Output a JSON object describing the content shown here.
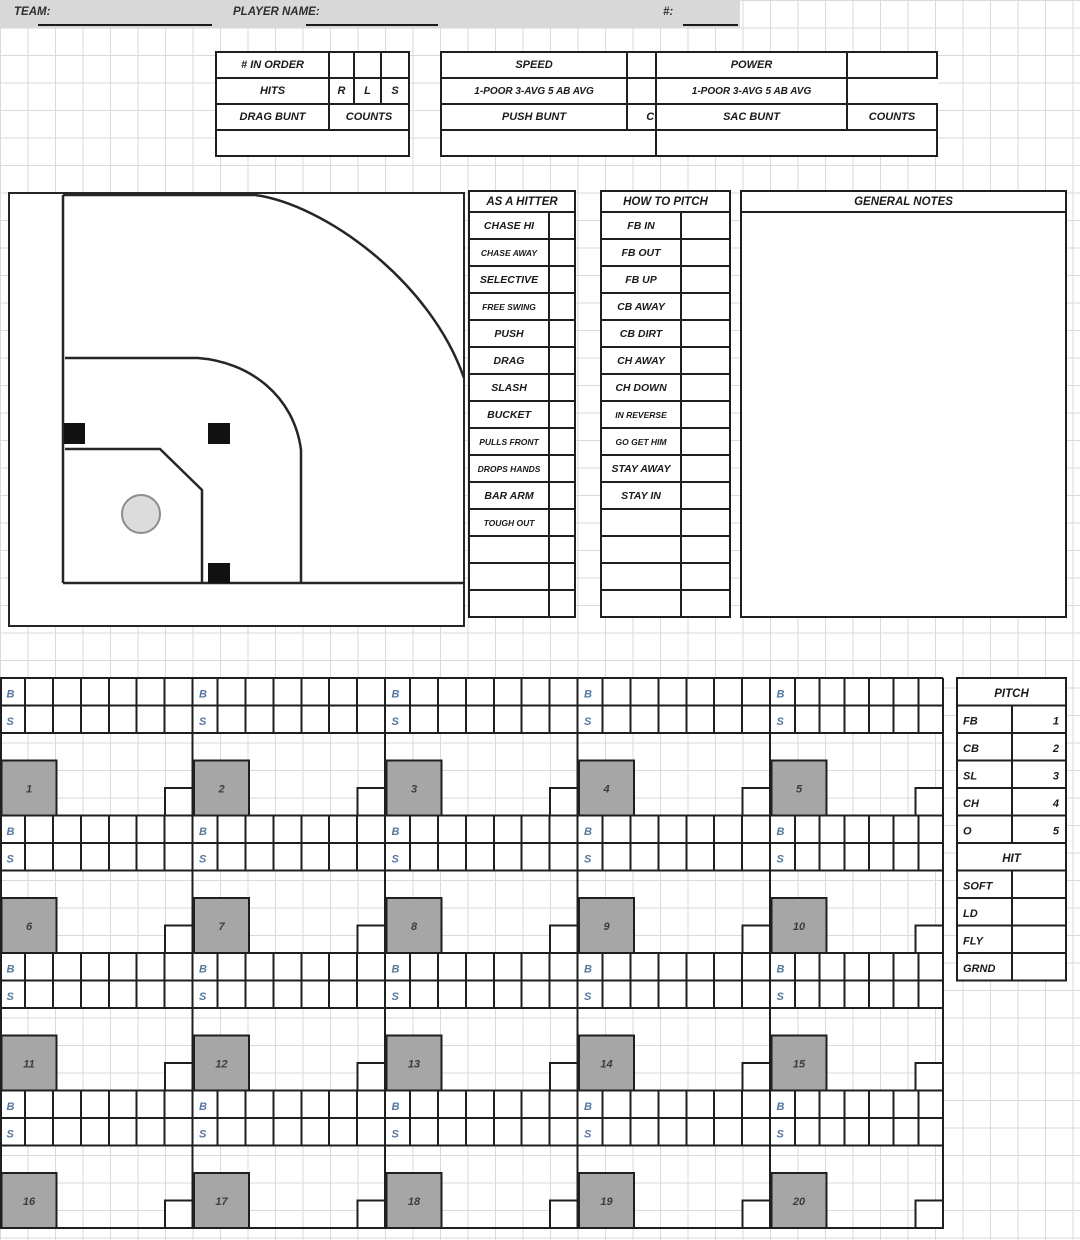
{
  "page": {
    "team_label": "TEAM:",
    "player_name_label": "PLAYER NAME:",
    "number_label": "#:"
  },
  "info_boxes": [
    {
      "rows": [
        [
          "# IN ORDER",
          "",
          "",
          ""
        ],
        [
          "HITS",
          "R",
          "L",
          "S"
        ],
        [
          "DRAG BUNT",
          "COUNTS"
        ],
        [
          ""
        ]
      ]
    },
    {
      "rows": [
        [
          "SPEED",
          ""
        ],
        [
          "1-POOR 3-AVG 5 AB AVG"
        ],
        [
          "PUSH BUNT",
          "COUNTS"
        ],
        [
          ""
        ]
      ]
    },
    {
      "rows": [
        [
          "POWER",
          ""
        ],
        [
          "1-POOR 3-AVG 5 AB AVG"
        ],
        [
          "SAC BUNT",
          "COUNTS"
        ],
        [
          ""
        ]
      ]
    }
  ],
  "hitter_table": {
    "header": "AS A HITTER",
    "rows": [
      "CHASE HI",
      "CHASE AWAY",
      "SELECTIVE",
      "FREE SWING",
      "PUSH",
      "DRAG",
      "SLASH",
      "BUCKET",
      "PULLS FRONT",
      "DROPS HANDS",
      "BAR ARM",
      "TOUGH OUT",
      "",
      "",
      ""
    ]
  },
  "pitch_table": {
    "header": "HOW TO PITCH",
    "rows": [
      "FB IN",
      "FB OUT",
      "FB UP",
      "CB AWAY",
      "CB DIRT",
      "CH AWAY",
      "CH DOWN",
      "IN REVERSE",
      "GO GET HIM",
      "STAY AWAY",
      "STAY IN",
      "",
      "",
      "",
      ""
    ]
  },
  "notes": {
    "header": "GENERAL NOTES"
  },
  "scoring": {
    "ball_label": "B",
    "strike_label": "S",
    "at_bats": [
      1,
      2,
      3,
      4,
      5,
      6,
      7,
      8,
      9,
      10,
      11,
      12,
      13,
      14,
      15,
      16,
      17,
      18,
      19,
      20
    ]
  },
  "pitch_legend": {
    "header": "PITCH",
    "rows": [
      [
        "FB",
        "1"
      ],
      [
        "CB",
        "2"
      ],
      [
        "SL",
        "3"
      ],
      [
        "CH",
        "4"
      ],
      [
        "O",
        "5"
      ]
    ]
  },
  "hit_legend": {
    "header": "HIT",
    "rows": [
      [
        "SOFT",
        ""
      ],
      [
        "LD",
        ""
      ],
      [
        "FLY",
        ""
      ],
      [
        "GRND",
        ""
      ]
    ]
  },
  "colors": {
    "strip_bg": "#d8d8d8",
    "line": "#1f1f1f",
    "marker_fill": "#a6a6a6",
    "bs_label": "#54779e",
    "number_text": "#3d3d3d"
  }
}
